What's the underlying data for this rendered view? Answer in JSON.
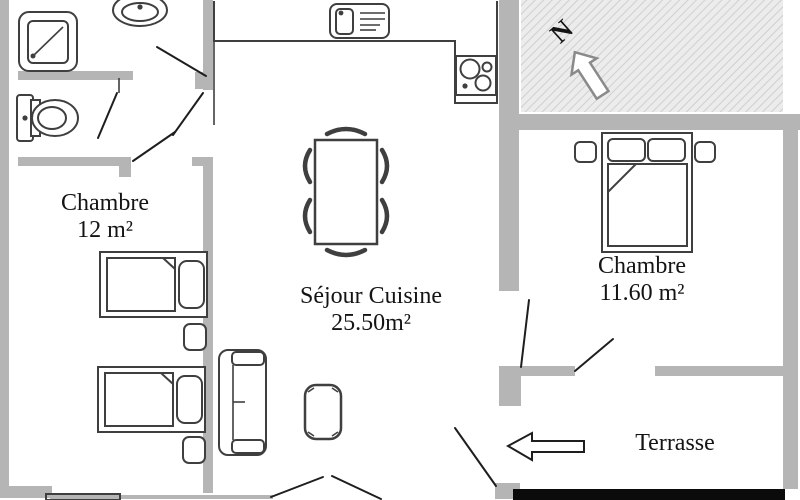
{
  "rooms": {
    "chambre_left": {
      "name": "Chambre",
      "area": "12 m²"
    },
    "sejour": {
      "name": "Séjour Cuisine",
      "area": "25.50m²"
    },
    "chambre_right": {
      "name": "Chambre",
      "area": "11.60 m²"
    },
    "terrasse": {
      "name": "Terrasse"
    }
  },
  "compass": {
    "north_label": "N"
  },
  "colors": {
    "wall": "#b5b5b5",
    "furniture": "#3f3f3f",
    "door_line": "#1e1e1e",
    "hatch_bg": "#ececec",
    "hatch_line": "#cfcfcf",
    "black_bar": "#0b0b0b",
    "text": "#141414",
    "background": "#ffffff",
    "compass_outline": "#8a8a8a"
  }
}
